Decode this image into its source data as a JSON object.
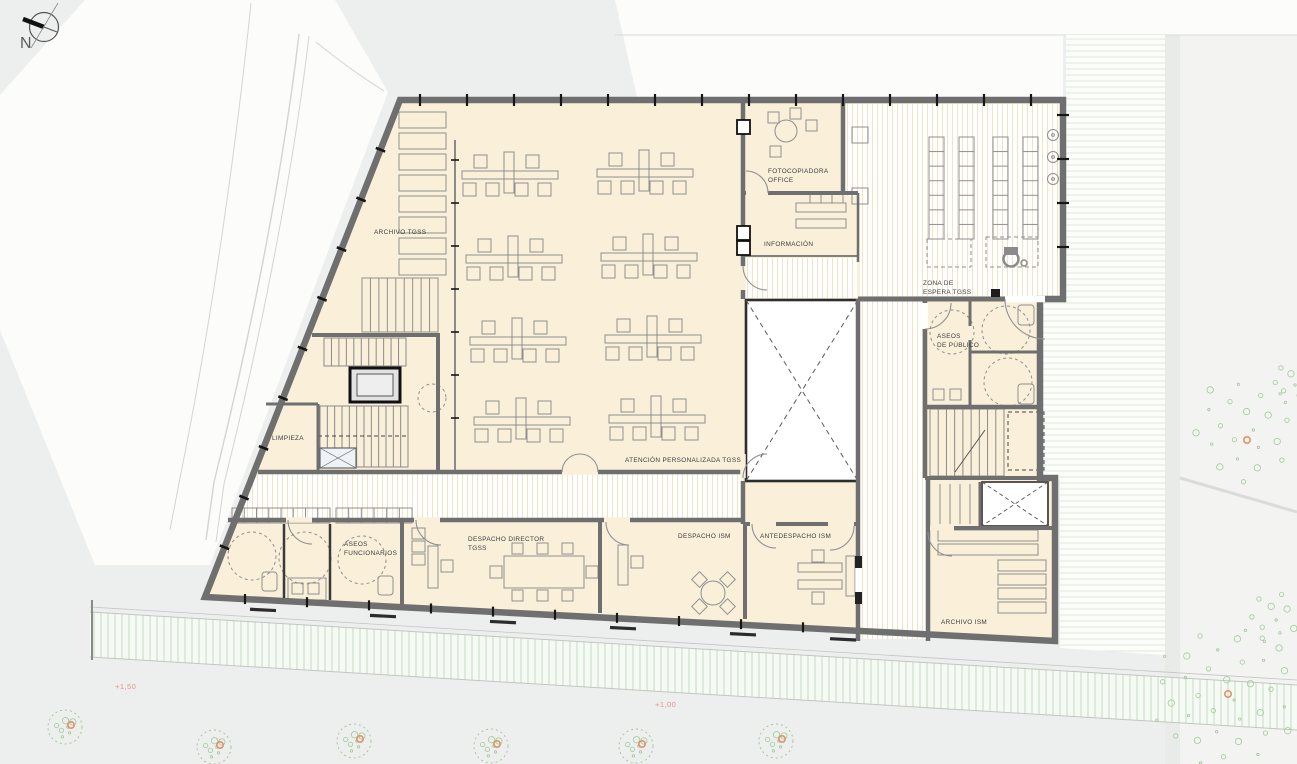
{
  "plan": {
    "compass_label": "N",
    "rooms": {
      "archivo_tgss": "ARCHIVO TGSS",
      "fotocopiadora_line1": "FOTOCOPIADORA",
      "fotocopiadora_line2": "OFFICE",
      "informacion": "INFORMACIÓN",
      "zona_espera_line1": "ZONA DE",
      "zona_espera_line2": "ESPERA TGSS",
      "aseos_publico_line1": "ASEOS",
      "aseos_publico_line2": "DE PÚBLICO",
      "limpieza": "LIMPIEZA",
      "atencion_personalizada": "ATENCIÓN PERSONALIZADA TGSS",
      "aseos_funcionarios_line1": "ASEOS",
      "aseos_funcionarios_line2": "FUNCIONARIOS",
      "despacho_director_line1": "DESPACHO DIRECTOR",
      "despacho_director_line2": "TGSS",
      "despacho_ism": "DESPACHO ISM",
      "antedespacho_ism": "ANTEDESPACHO ISM",
      "archivo_ism": "ARCHIVO ISM"
    },
    "levels": {
      "terrace": "+1,50",
      "plaza": "+1,00"
    },
    "icons": {
      "compass": "compass-rose-icon",
      "wheelchair": "wheelchair-icon"
    }
  },
  "colors": {
    "bg": "#edefee",
    "paper_white": "#fcfcfb",
    "right_zone": "#f3f4f2",
    "room_fill": "#faf0da",
    "wall_gray": "#6f6f6f",
    "dark_line": "#1c1c1c",
    "label_dark": "#3c3c3c",
    "level_red": "#e9908f",
    "tree_green": "#a3c89b",
    "tree_orange": "#dd9466",
    "furniture_gray": "#8f8f8f",
    "atrium_border": "#2e2e2e"
  }
}
